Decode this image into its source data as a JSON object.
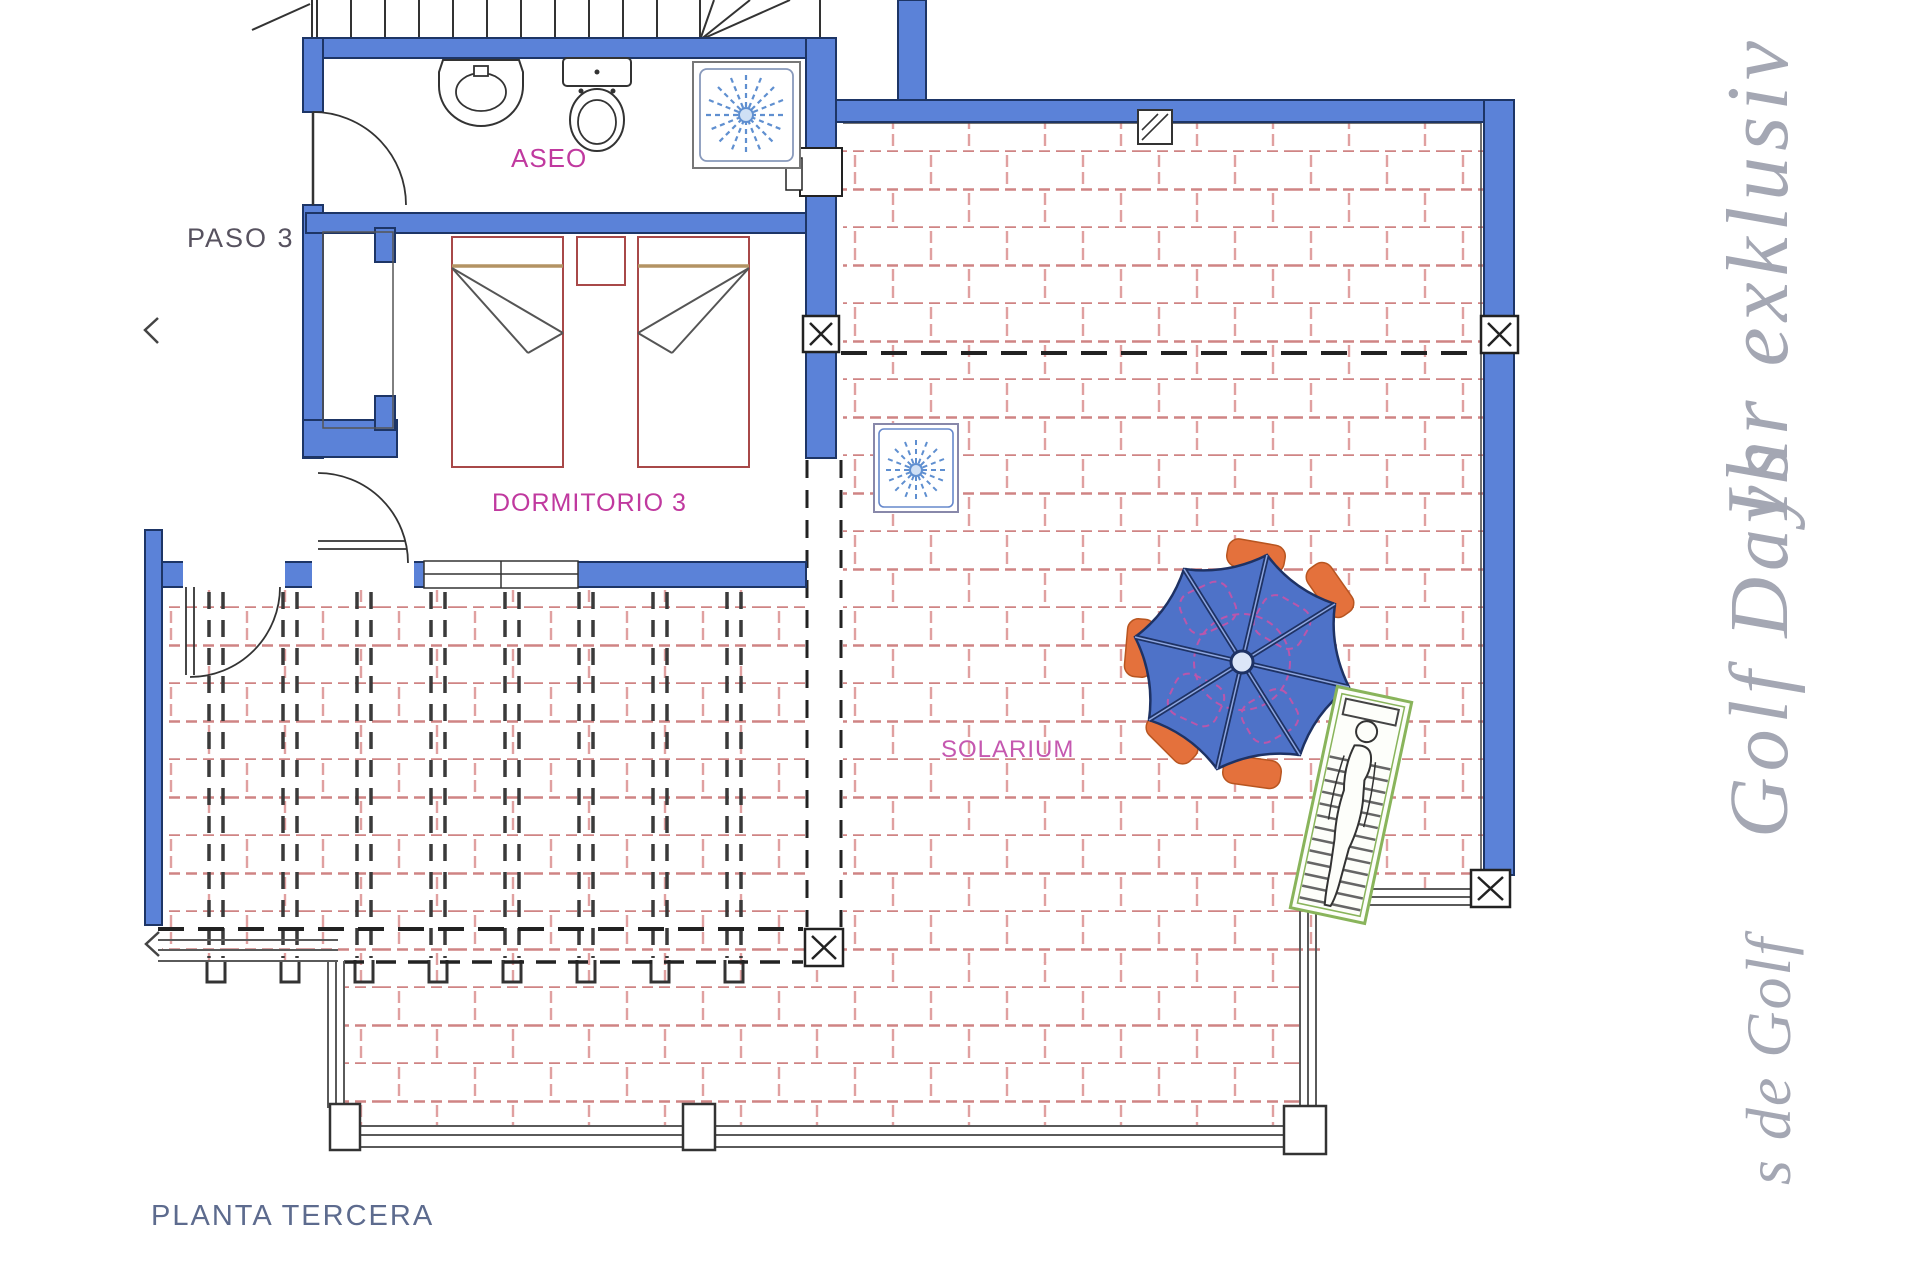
{
  "document": {
    "plan_title": "PLANTA TERCERA"
  },
  "rooms": {
    "aseo": "ASEO",
    "paso": "PASO 3",
    "dormitorio": "DORMITORIO 3",
    "solarium": "SOLARIUM"
  },
  "watermark": {
    "top": "Ihr exklusiv",
    "middle": "Golf Days",
    "bottom": "s de Golf"
  },
  "colors": {
    "wall_blue": "#5b82d8",
    "wall_outline": "#1d3566",
    "tile_pink": "#d98a8a",
    "label_magenta": "#c0399f",
    "solarium_magenta": "#c558b0",
    "paso_gray": "#57525f",
    "title_blue": "#5d6b8e",
    "watermark_gray": "#a4a7b3",
    "umbrella_blue": "#4e72c8",
    "umbrella_rib": "#1e3264",
    "chair_orange": "#e4713c",
    "lounger_green": "#89b45b",
    "sunray_blue": "#5f8fd0",
    "bed_red": "#a84848",
    "pillow_tan": "#b39363"
  }
}
